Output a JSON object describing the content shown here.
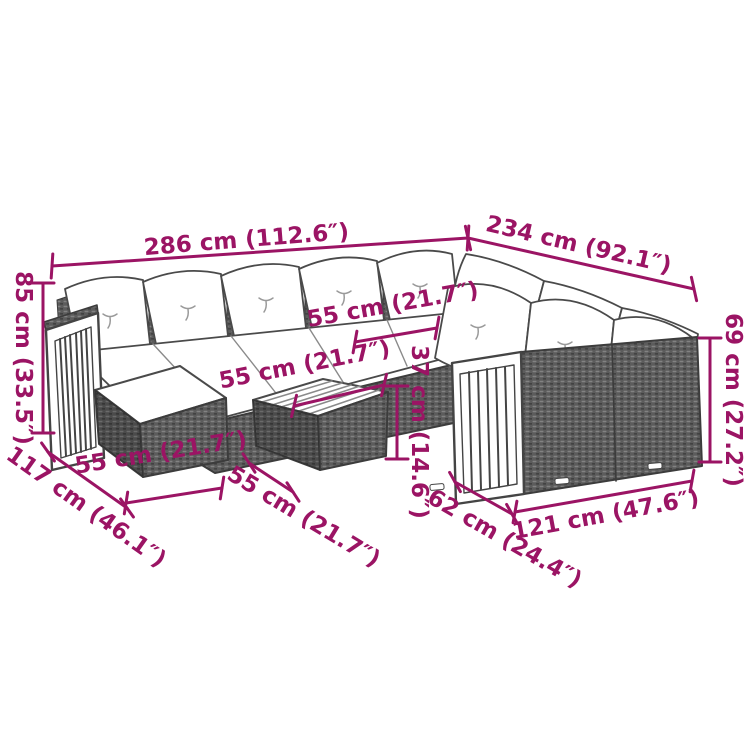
{
  "colors": {
    "accent": "#9b1464",
    "outline": "#4a4a4a",
    "rattan_base": "#5c5c5c",
    "cushion": "#ffffff"
  },
  "dimensions": {
    "total_width": {
      "cm": 286,
      "in": 112.6,
      "label": "286 cm (112.6″)"
    },
    "right_depth": {
      "cm": 234,
      "in": 92.1,
      "label": "234 cm (92.1″)"
    },
    "back_height": {
      "cm": 85,
      "in": 33.5,
      "label": "85 cm (33.5″)"
    },
    "seat_width": {
      "cm": 55,
      "in": 21.7,
      "label": "55 cm (21.7″)"
    },
    "table_width": {
      "cm": 55,
      "in": 21.7,
      "label": "55 cm (21.7″)"
    },
    "table_height": {
      "cm": 37,
      "in": 14.6,
      "label": "37 cm (14.6″)"
    },
    "ottoman_width": {
      "cm": 55,
      "in": 21.7,
      "label": "55 cm (21.7″)"
    },
    "left_depth": {
      "cm": 117,
      "in": 46.1,
      "label": "117 cm (46.1″)"
    },
    "table_depth": {
      "cm": 55,
      "in": 21.7,
      "label": "55 cm (21.7″)"
    },
    "right_seat_depth": {
      "cm": 62,
      "in": 24.4,
      "label": "62 cm (24.4″)"
    },
    "right_front_width": {
      "cm": 121,
      "in": 47.6,
      "label": "121 cm (47.6″)"
    },
    "right_arm_height": {
      "cm": 69,
      "in": 27.2,
      "label": "69 cm (27.2″)"
    }
  }
}
